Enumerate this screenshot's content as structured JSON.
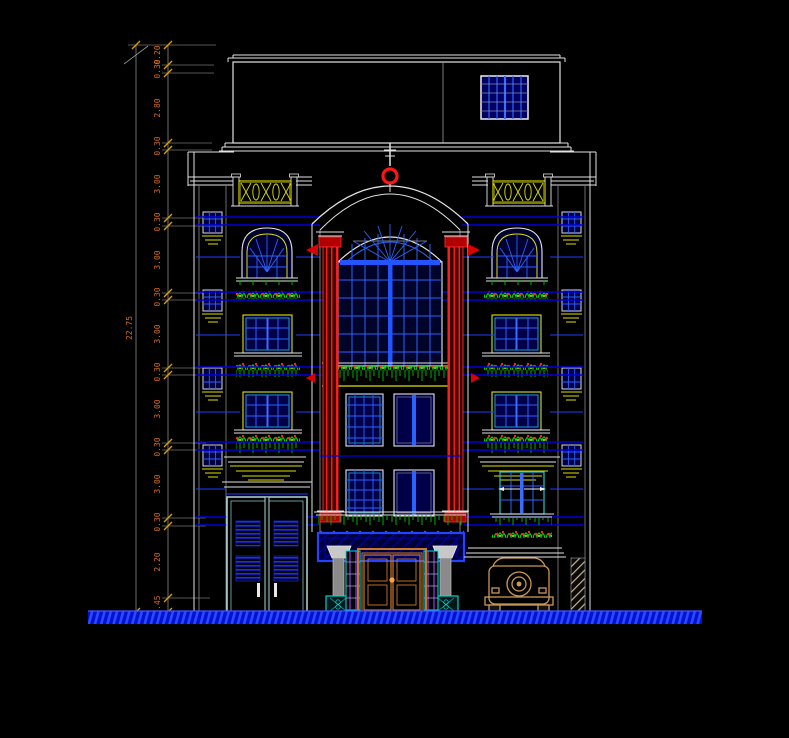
{
  "drawing": {
    "type": "cad-front-elevation",
    "floors_visible": 7
  },
  "dims": {
    "overall": "22.75",
    "chain": [
      "0.20",
      "0.30",
      "2.80",
      "0.30",
      "3.00",
      "0.30",
      "3.00",
      "0.30",
      "3.00",
      "0.30",
      "3.00",
      "0.30",
      "3.00",
      "0.30",
      "2.20",
      "0.45"
    ]
  },
  "colors": {
    "background": "#000000",
    "outline_white": "#E2E2E2",
    "mullion_blue": "#2A62FF",
    "glazing_navy": "#000048",
    "slab_line_blue": "#0000DC",
    "accent_bright_blue": "#2244FF",
    "column_red": "#FF1515",
    "plant_green": "#00D800",
    "flower_red": "#FF2020",
    "trim_yellow": "#E0E000",
    "frame_cyan": "#20C8C8",
    "door_orange": "#C87828",
    "dim_text_orange": "#D2691E",
    "ground_blue": "#0012D0",
    "car_tan": "#C89858"
  },
  "icons": {
    "roof_finial": "ring-ornament",
    "parapet_panel": "x-lattice-railing"
  }
}
